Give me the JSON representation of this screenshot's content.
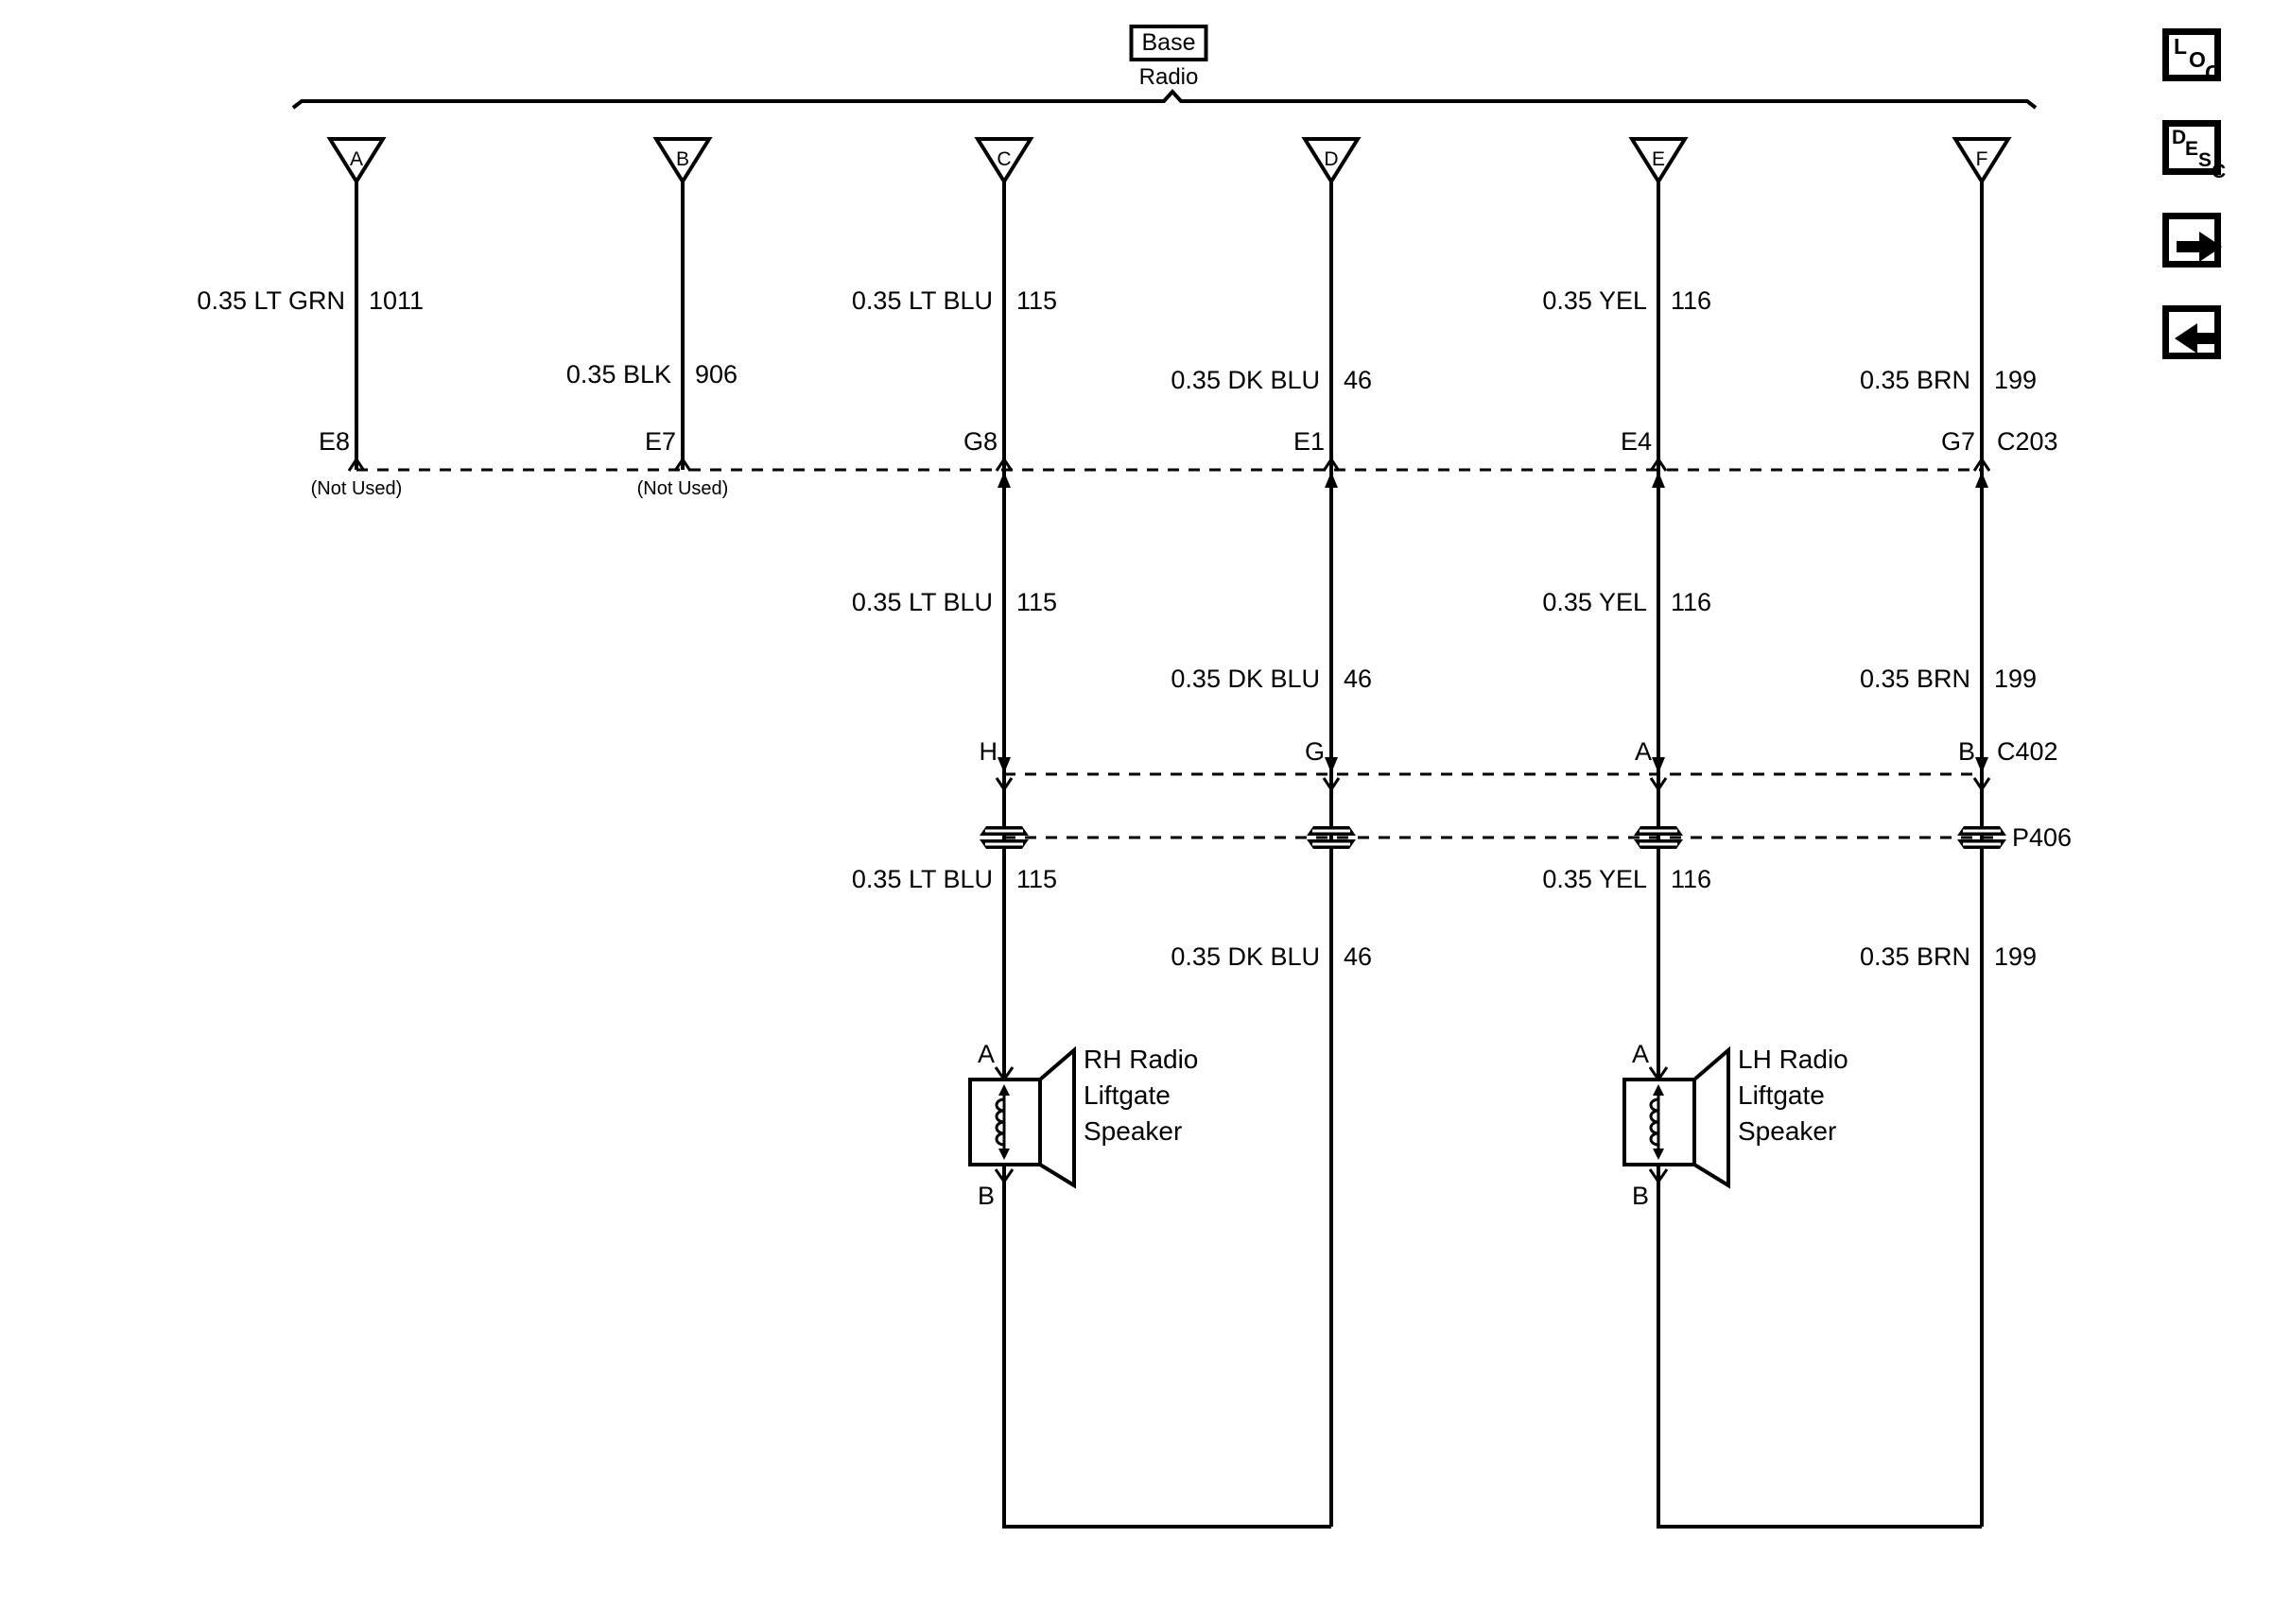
{
  "header": {
    "variant": "Base",
    "component": "Radio"
  },
  "connectors": {
    "c203": "C203",
    "c402": "C402",
    "p406": "P406"
  },
  "branches": [
    {
      "triangle": "A",
      "wire": {
        "color": "0.35 LT GRN",
        "circuit": "1011"
      },
      "c203_pin": "E8",
      "c203_note": "(Not Used)"
    },
    {
      "triangle": "B",
      "wire": {
        "color": "0.35 BLK",
        "circuit": "906"
      },
      "c203_pin": "E7",
      "c203_note": "(Not Used)"
    },
    {
      "triangle": "C",
      "wire": {
        "color": "0.35 LT BLU",
        "circuit": "115"
      },
      "c203_pin": "G8",
      "wire2": {
        "color": "0.35 LT BLU",
        "circuit": "115"
      },
      "c402_pin": "H",
      "wire3": {
        "color": "0.35 LT BLU",
        "circuit": "115"
      },
      "speaker": {
        "pin_top": "A",
        "pin_bottom": "B",
        "name_lines": [
          "RH Radio",
          "Liftgate",
          "Speaker"
        ]
      }
    },
    {
      "triangle": "D",
      "wire": {
        "color": "0.35 DK BLU",
        "circuit": "46"
      },
      "c203_pin": "E1",
      "wire2": {
        "color": "0.35 DK BLU",
        "circuit": "46"
      },
      "c402_pin": "G",
      "wire3": {
        "color": "0.35 DK BLU",
        "circuit": "46"
      }
    },
    {
      "triangle": "E",
      "wire": {
        "color": "0.35 YEL",
        "circuit": "116"
      },
      "c203_pin": "E4",
      "wire2": {
        "color": "0.35 YEL",
        "circuit": "116"
      },
      "c402_pin": "A",
      "wire3": {
        "color": "0.35 YEL",
        "circuit": "116"
      },
      "speaker": {
        "pin_top": "A",
        "pin_bottom": "B",
        "name_lines": [
          "LH Radio",
          "Liftgate",
          "Speaker"
        ]
      }
    },
    {
      "triangle": "F",
      "wire": {
        "color": "0.35 BRN",
        "circuit": "199"
      },
      "c203_pin": "G7",
      "wire2": {
        "color": "0.35 BRN",
        "circuit": "199"
      },
      "c402_pin": "B",
      "wire3": {
        "color": "0.35 BRN",
        "circuit": "199"
      }
    }
  ],
  "toolbar": {
    "loc": [
      "L",
      "O",
      "C"
    ],
    "desc": [
      "D",
      "E",
      "S",
      "C"
    ]
  },
  "colors": {
    "ink": "#000000",
    "paper": "#ffffff"
  }
}
